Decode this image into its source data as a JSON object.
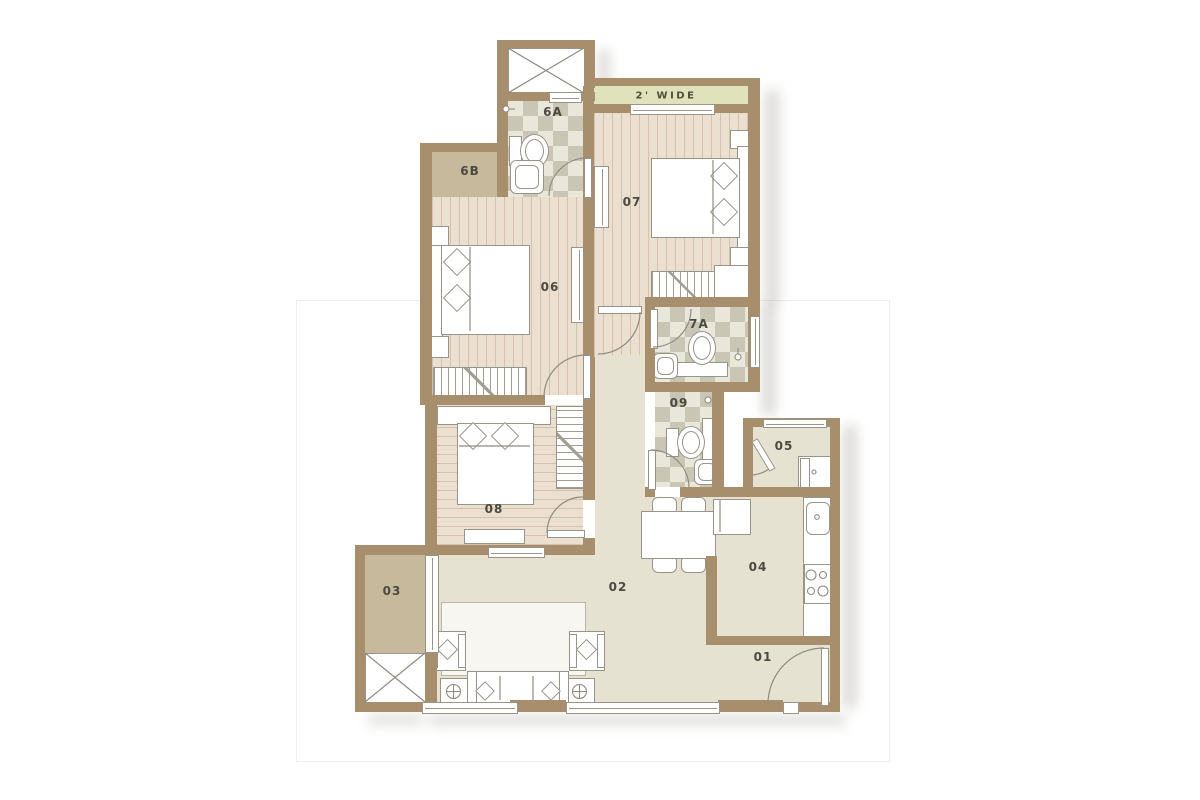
{
  "labels": {
    "balcony": "2' WIDE",
    "r01": "01",
    "r02": "02",
    "r03": "03",
    "r04": "04",
    "r05": "05",
    "r06": "06",
    "r07": "07",
    "r08": "08",
    "r09": "09",
    "r6A": "6A",
    "r6B": "6B",
    "r7A": "7A"
  },
  "colors": {
    "wall": "#a78e6d",
    "floor_cream": "#e6e2d2",
    "floor_wood": "#ebdfcf",
    "floor_tan": "#c6b99c",
    "balcony_green": "#dfe2ba",
    "checker_tint": "#cfcbbc",
    "furniture_line": "#98948a",
    "label_text": "#4b4940"
  }
}
